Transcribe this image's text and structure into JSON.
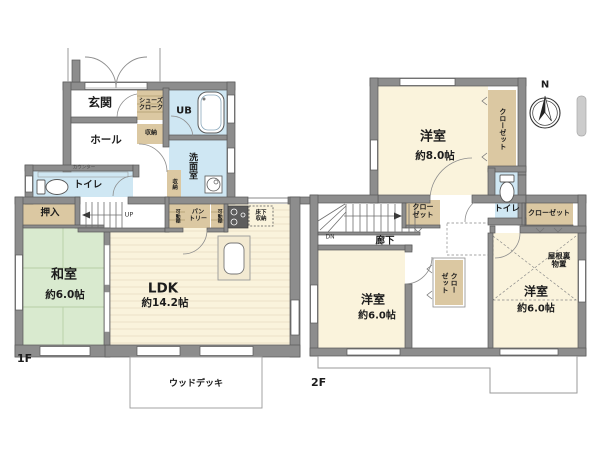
{
  "colors": {
    "wall_fill": "#8d8d8d",
    "wall_edge": "#585858",
    "room_cream": "#faf3dc",
    "plank_line": "#e7dcc1",
    "wet_blue": "#cfe7f3",
    "tatami_green": "#d9eacf",
    "tatami_line": "#b6cfa6",
    "closet_tan": "#dbc8a2",
    "thin_line": "#9a9a9a"
  },
  "f1": {
    "floor": "1F",
    "genkan": "玄関",
    "shoes_closet": "シューズ\nクローク",
    "ub": "UB",
    "hall": "ホール",
    "storage_a": "収納",
    "storage_b": "収納",
    "washroom": "洗面室",
    "counter": "カウンター",
    "toilet": "トイレ",
    "oshiire": "押入",
    "up": "UP",
    "washitsu": "和室",
    "washitsu_size": "約6.0帖",
    "ldk": "LDK",
    "ldk_size": "約14.2帖",
    "pantry": "パン\nトリー",
    "shelf_left": "可動棚",
    "shelf_right": "可動棚",
    "floor_storage": "床下\n収納",
    "wood_deck": "ウッドデッキ"
  },
  "f2": {
    "floor": "2F",
    "room8": "洋室",
    "room8_size": "約8.0帖",
    "closet_right": "クローゼット",
    "toilet": "トイレ",
    "closet_top_right": "クローゼット",
    "closet_stairs": "クロー\nゼット",
    "dn": "DN",
    "hallway": "廊下",
    "room6_left": "洋室",
    "room6_left_size": "約6.0帖",
    "closet_mid": "クロー\nゼット",
    "attic": "屋根裏\n物置",
    "room6_right": "洋室",
    "room6_right_size": "約6.0帖",
    "compass_n": "N"
  }
}
